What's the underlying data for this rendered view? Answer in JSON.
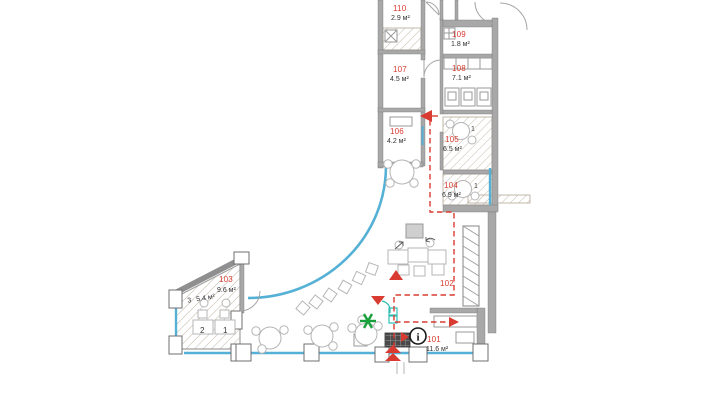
{
  "plan": {
    "title": "cafe-floor-plan",
    "rooms": {
      "r101": {
        "number": "101",
        "area": "11.6 м²"
      },
      "r102": {
        "number": "102"
      },
      "r103": {
        "number": "103",
        "area": "9.6 м²"
      },
      "r104": {
        "number": "104",
        "area": "6.9 м²"
      },
      "r105": {
        "number": "105",
        "area": "6.5 м²"
      },
      "r106": {
        "number": "106",
        "area": "4.2 м²"
      },
      "r107": {
        "number": "107",
        "area": "4.5 м²"
      },
      "r108": {
        "number": "108",
        "area": "7.1 м²"
      },
      "r109": {
        "number": "109",
        "area": "1.8 м²"
      },
      "r110": {
        "number": "110",
        "area": "2.9 м²"
      }
    },
    "annotations": {
      "zone_number": "3",
      "zone_area": "5.4 м²",
      "desk_left": "2",
      "desk_right": "1",
      "item_105": "1",
      "item_104": "1",
      "info_symbol": "i"
    },
    "icons": {
      "info_icon": "circle-i",
      "plant_icon": "six-ray-star",
      "entry_arrow_icon": "double-chevron-up",
      "route_arrow_icon": "filled-triangle"
    },
    "colors": {
      "glazing_blue": "#55b0d5",
      "route_red": "#da3b30",
      "plant_green": "#18a13a",
      "teal": "#2fbdb3",
      "wall_gray": "#a8a8a8",
      "hatch_tan": "#c3b9a9"
    }
  }
}
